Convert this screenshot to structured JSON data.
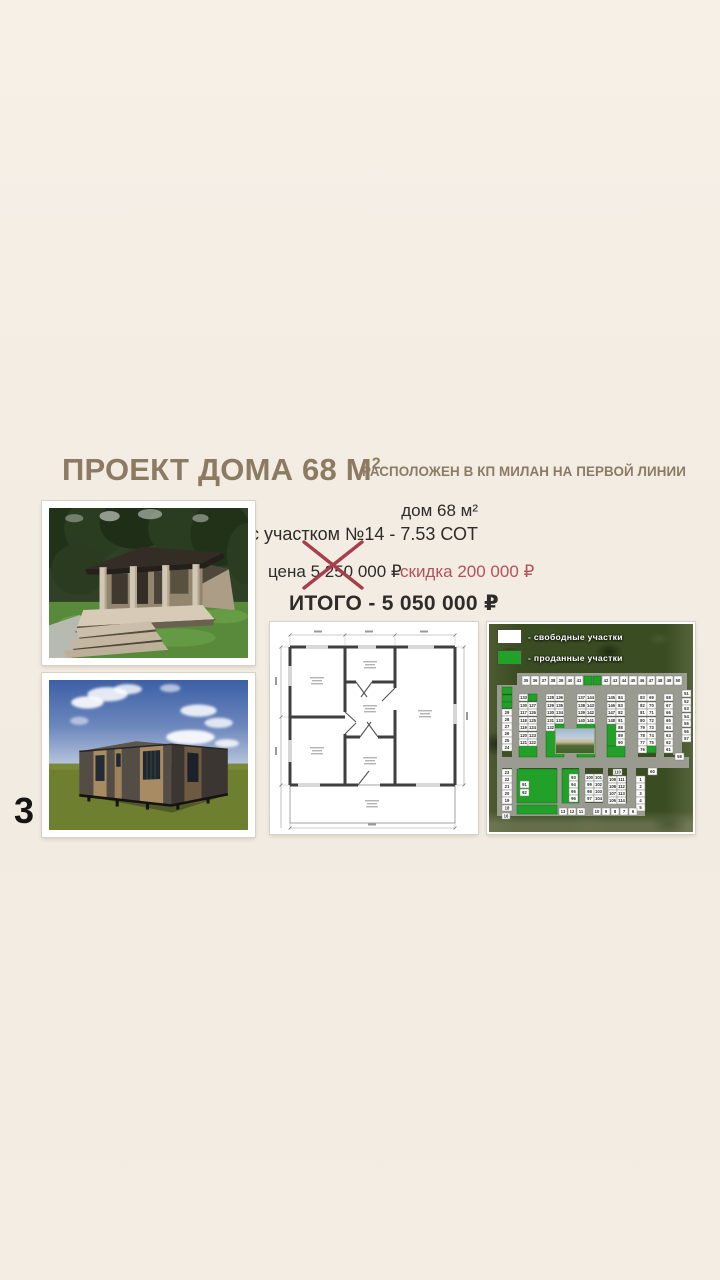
{
  "slide": {
    "number": "3"
  },
  "header": {
    "title_main": "ПРОЕКТ ДОМА 68 М",
    "title_sup": "2",
    "subtitle": "РАСПОЛОЖЕН В КП МИЛАН НА ПЕРВОЙ ЛИНИИ",
    "accent_color": "#8c7b63"
  },
  "offer": {
    "house_line": "дом 68 м²",
    "plot_line": "с участком №14 - 7.53 СОТ",
    "old_price": "цена 5 250 000 ₽",
    "discount": "скидка 200 000 ₽",
    "total": "ИТОГО - 5 050 000 ₽",
    "discount_color": "#b4515b"
  },
  "map": {
    "free_color": "#ffffff",
    "sold_color": "#21a127",
    "legend": [
      {
        "color": "#ffffff",
        "label": "- свободные участки"
      },
      {
        "color": "#21a127",
        "label": "- проданные участки"
      }
    ],
    "areas": [
      {
        "x": 30,
        "y": 122,
        "w": 18,
        "h": 11
      },
      {
        "x": 57,
        "y": 107,
        "w": 18,
        "h": 26
      },
      {
        "x": 88,
        "y": 100,
        "w": 18,
        "h": 33
      },
      {
        "x": 118,
        "y": 100,
        "w": 9,
        "h": 22
      },
      {
        "x": 118,
        "y": 122,
        "w": 18,
        "h": 11
      },
      {
        "x": 28,
        "y": 145,
        "w": 40,
        "h": 34
      },
      {
        "x": 73,
        "y": 145,
        "w": 17,
        "h": 34
      },
      {
        "x": 28,
        "y": 181,
        "w": 40,
        "h": 9
      }
    ],
    "cells": [
      {
        "x": 33,
        "y": 52,
        "w": 8,
        "h": 9,
        "n": "35"
      },
      {
        "x": 42,
        "y": 52,
        "w": 8,
        "h": 9,
        "n": "36"
      },
      {
        "x": 51,
        "y": 52,
        "w": 8,
        "h": 9,
        "n": "37"
      },
      {
        "x": 60,
        "y": 52,
        "w": 8,
        "h": 9,
        "n": "38"
      },
      {
        "x": 68,
        "y": 52,
        "w": 8,
        "h": 9,
        "n": "39"
      },
      {
        "x": 77,
        "y": 52,
        "w": 8,
        "h": 9,
        "n": "40"
      },
      {
        "x": 86,
        "y": 52,
        "w": 8,
        "h": 9,
        "n": "41"
      },
      {
        "x": 95,
        "y": 52,
        "w": 8,
        "h": 9,
        "s": 1
      },
      {
        "x": 104,
        "y": 52,
        "w": 8,
        "h": 9,
        "s": 1
      },
      {
        "x": 113,
        "y": 52,
        "w": 8,
        "h": 9,
        "n": "42"
      },
      {
        "x": 122,
        "y": 52,
        "w": 8,
        "h": 9,
        "n": "43"
      },
      {
        "x": 131,
        "y": 52,
        "w": 8,
        "h": 9,
        "n": "44"
      },
      {
        "x": 140,
        "y": 52,
        "w": 8,
        "h": 9,
        "n": "45"
      },
      {
        "x": 149,
        "y": 52,
        "w": 8,
        "h": 9,
        "n": "46"
      },
      {
        "x": 158,
        "y": 52,
        "w": 8,
        "h": 9,
        "n": "47"
      },
      {
        "x": 167,
        "y": 52,
        "w": 8,
        "h": 9,
        "n": "48"
      },
      {
        "x": 176,
        "y": 52,
        "w": 8,
        "h": 9,
        "n": "49"
      },
      {
        "x": 185,
        "y": 52,
        "w": 8,
        "h": 9,
        "n": "50"
      },
      {
        "x": 193,
        "y": 66,
        "w": 9,
        "h": 7,
        "n": "51"
      },
      {
        "x": 193,
        "y": 74,
        "w": 9,
        "h": 7,
        "n": "52"
      },
      {
        "x": 193,
        "y": 81,
        "w": 9,
        "h": 7,
        "n": "53"
      },
      {
        "x": 193,
        "y": 89,
        "w": 9,
        "h": 7,
        "n": "54"
      },
      {
        "x": 193,
        "y": 96,
        "w": 9,
        "h": 7,
        "n": "55"
      },
      {
        "x": 193,
        "y": 104,
        "w": 9,
        "h": 7,
        "n": "56"
      },
      {
        "x": 193,
        "y": 111,
        "w": 9,
        "h": 7,
        "n": "57"
      },
      {
        "x": 186,
        "y": 129,
        "w": 9,
        "h": 7,
        "n": "58"
      },
      {
        "x": 13,
        "y": 63,
        "w": 10,
        "h": 7,
        "s": 1
      },
      {
        "x": 13,
        "y": 71,
        "w": 10,
        "h": 7,
        "s": 1
      },
      {
        "x": 13,
        "y": 78,
        "w": 10,
        "h": 6,
        "s": 1
      },
      {
        "x": 13,
        "y": 85,
        "w": 10,
        "h": 7,
        "n": "29"
      },
      {
        "x": 13,
        "y": 92,
        "w": 10,
        "h": 7,
        "n": "28"
      },
      {
        "x": 13,
        "y": 99,
        "w": 10,
        "h": 7,
        "n": "27"
      },
      {
        "x": 13,
        "y": 106,
        "w": 10,
        "h": 7,
        "n": "26"
      },
      {
        "x": 13,
        "y": 113,
        "w": 10,
        "h": 7,
        "n": "25"
      },
      {
        "x": 13,
        "y": 120,
        "w": 10,
        "h": 7,
        "n": "24"
      },
      {
        "x": 30,
        "y": 70,
        "w": 9,
        "h": 7,
        "n": "133"
      },
      {
        "x": 39,
        "y": 70,
        "w": 9,
        "h": 7,
        "s": 1
      },
      {
        "x": 30,
        "y": 78,
        "w": 9,
        "h": 7,
        "n": "130"
      },
      {
        "x": 39,
        "y": 78,
        "w": 9,
        "h": 7,
        "n": "127"
      },
      {
        "x": 30,
        "y": 85,
        "w": 9,
        "h": 7,
        "n": "117"
      },
      {
        "x": 39,
        "y": 85,
        "w": 9,
        "h": 7,
        "n": "126"
      },
      {
        "x": 30,
        "y": 93,
        "w": 9,
        "h": 7,
        "n": "118"
      },
      {
        "x": 39,
        "y": 93,
        "w": 9,
        "h": 7,
        "n": "125"
      },
      {
        "x": 30,
        "y": 100,
        "w": 9,
        "h": 7,
        "n": "119"
      },
      {
        "x": 39,
        "y": 100,
        "w": 9,
        "h": 7,
        "n": "124"
      },
      {
        "x": 30,
        "y": 108,
        "w": 9,
        "h": 7,
        "n": "120"
      },
      {
        "x": 39,
        "y": 108,
        "w": 9,
        "h": 7,
        "n": "123"
      },
      {
        "x": 30,
        "y": 115,
        "w": 9,
        "h": 7,
        "n": "121"
      },
      {
        "x": 39,
        "y": 115,
        "w": 9,
        "h": 7,
        "n": "122"
      },
      {
        "x": 57,
        "y": 70,
        "w": 9,
        "h": 7,
        "n": "128"
      },
      {
        "x": 66,
        "y": 70,
        "w": 9,
        "h": 7,
        "n": "136"
      },
      {
        "x": 57,
        "y": 78,
        "w": 9,
        "h": 7,
        "n": "129"
      },
      {
        "x": 66,
        "y": 78,
        "w": 9,
        "h": 7,
        "n": "135"
      },
      {
        "x": 57,
        "y": 85,
        "w": 9,
        "h": 7,
        "n": "130"
      },
      {
        "x": 66,
        "y": 85,
        "w": 9,
        "h": 7,
        "n": "134"
      },
      {
        "x": 57,
        "y": 93,
        "w": 9,
        "h": 7,
        "n": "131"
      },
      {
        "x": 66,
        "y": 93,
        "w": 9,
        "h": 7,
        "n": "133"
      },
      {
        "x": 57,
        "y": 100,
        "w": 9,
        "h": 7,
        "n": "132"
      },
      {
        "x": 66,
        "y": 100,
        "w": 9,
        "h": 7,
        "s": 1
      },
      {
        "x": 88,
        "y": 70,
        "w": 9,
        "h": 7,
        "n": "137"
      },
      {
        "x": 97,
        "y": 70,
        "w": 9,
        "h": 7,
        "n": "144"
      },
      {
        "x": 88,
        "y": 78,
        "w": 9,
        "h": 7,
        "n": "138"
      },
      {
        "x": 97,
        "y": 78,
        "w": 9,
        "h": 7,
        "n": "143"
      },
      {
        "x": 88,
        "y": 85,
        "w": 9,
        "h": 7,
        "n": "139"
      },
      {
        "x": 97,
        "y": 85,
        "w": 9,
        "h": 7,
        "n": "142"
      },
      {
        "x": 88,
        "y": 93,
        "w": 9,
        "h": 7,
        "n": "140"
      },
      {
        "x": 97,
        "y": 93,
        "w": 9,
        "h": 7,
        "n": "141"
      },
      {
        "x": 118,
        "y": 70,
        "w": 9,
        "h": 7,
        "n": "145"
      },
      {
        "x": 127,
        "y": 70,
        "w": 9,
        "h": 7,
        "n": "84"
      },
      {
        "x": 118,
        "y": 78,
        "w": 9,
        "h": 7,
        "n": "146"
      },
      {
        "x": 127,
        "y": 78,
        "w": 9,
        "h": 7,
        "n": "83"
      },
      {
        "x": 118,
        "y": 85,
        "w": 9,
        "h": 7,
        "n": "147"
      },
      {
        "x": 127,
        "y": 85,
        "w": 9,
        "h": 7,
        "n": "82"
      },
      {
        "x": 118,
        "y": 93,
        "w": 9,
        "h": 7,
        "n": "148"
      },
      {
        "x": 127,
        "y": 93,
        "w": 9,
        "h": 7,
        "n": "81"
      },
      {
        "x": 127,
        "y": 100,
        "w": 9,
        "h": 7,
        "n": "88"
      },
      {
        "x": 127,
        "y": 108,
        "w": 9,
        "h": 7,
        "n": "89"
      },
      {
        "x": 127,
        "y": 115,
        "w": 9,
        "h": 7,
        "n": "90"
      },
      {
        "x": 149,
        "y": 70,
        "w": 9,
        "h": 7,
        "n": "83"
      },
      {
        "x": 158,
        "y": 70,
        "w": 9,
        "h": 7,
        "n": "69"
      },
      {
        "x": 149,
        "y": 78,
        "w": 9,
        "h": 7,
        "n": "82"
      },
      {
        "x": 158,
        "y": 78,
        "w": 9,
        "h": 7,
        "n": "70"
      },
      {
        "x": 149,
        "y": 85,
        "w": 9,
        "h": 7,
        "n": "81"
      },
      {
        "x": 158,
        "y": 85,
        "w": 9,
        "h": 7,
        "n": "71"
      },
      {
        "x": 149,
        "y": 93,
        "w": 9,
        "h": 7,
        "n": "80"
      },
      {
        "x": 158,
        "y": 93,
        "w": 9,
        "h": 7,
        "n": "72"
      },
      {
        "x": 149,
        "y": 100,
        "w": 9,
        "h": 7,
        "n": "79"
      },
      {
        "x": 158,
        "y": 100,
        "w": 9,
        "h": 7,
        "n": "73"
      },
      {
        "x": 149,
        "y": 108,
        "w": 9,
        "h": 7,
        "n": "78"
      },
      {
        "x": 158,
        "y": 108,
        "w": 9,
        "h": 7,
        "n": "74"
      },
      {
        "x": 149,
        "y": 115,
        "w": 9,
        "h": 7,
        "n": "77"
      },
      {
        "x": 158,
        "y": 115,
        "w": 9,
        "h": 7,
        "n": "75"
      },
      {
        "x": 149,
        "y": 122,
        "w": 9,
        "h": 7,
        "n": "76"
      },
      {
        "x": 158,
        "y": 122,
        "w": 9,
        "h": 7,
        "s": 1
      },
      {
        "x": 175,
        "y": 70,
        "w": 9,
        "h": 7,
        "n": "68"
      },
      {
        "x": 175,
        "y": 78,
        "w": 9,
        "h": 7,
        "n": "67"
      },
      {
        "x": 175,
        "y": 85,
        "w": 9,
        "h": 7,
        "n": "66"
      },
      {
        "x": 175,
        "y": 93,
        "w": 9,
        "h": 7,
        "n": "65"
      },
      {
        "x": 175,
        "y": 100,
        "w": 9,
        "h": 7,
        "n": "64"
      },
      {
        "x": 175,
        "y": 108,
        "w": 9,
        "h": 7,
        "n": "63"
      },
      {
        "x": 175,
        "y": 115,
        "w": 9,
        "h": 7,
        "n": "62"
      },
      {
        "x": 175,
        "y": 122,
        "w": 9,
        "h": 7,
        "n": "61"
      },
      {
        "x": 13,
        "y": 145,
        "w": 10,
        "h": 7,
        "n": "23"
      },
      {
        "x": 13,
        "y": 152,
        "w": 10,
        "h": 7,
        "n": "22"
      },
      {
        "x": 13,
        "y": 159,
        "w": 10,
        "h": 7,
        "n": "21"
      },
      {
        "x": 13,
        "y": 166,
        "w": 10,
        "h": 7,
        "n": "20"
      },
      {
        "x": 13,
        "y": 173,
        "w": 10,
        "h": 7,
        "n": "19"
      },
      {
        "x": 13,
        "y": 181,
        "w": 10,
        "h": 6,
        "n": "18"
      },
      {
        "x": 13,
        "y": 189,
        "w": 8,
        "h": 6,
        "n": "16"
      },
      {
        "x": 31,
        "y": 157,
        "w": 9,
        "h": 7,
        "n": "91"
      },
      {
        "x": 31,
        "y": 165,
        "w": 9,
        "h": 7,
        "n": "92"
      },
      {
        "x": 80,
        "y": 150,
        "w": 9,
        "h": 7,
        "n": "93"
      },
      {
        "x": 80,
        "y": 157,
        "w": 9,
        "h": 7,
        "n": "94"
      },
      {
        "x": 80,
        "y": 164,
        "w": 9,
        "h": 7,
        "n": "95"
      },
      {
        "x": 80,
        "y": 171,
        "w": 9,
        "h": 7,
        "n": "96"
      },
      {
        "x": 96,
        "y": 150,
        "w": 9,
        "h": 7,
        "n": "100"
      },
      {
        "x": 105,
        "y": 150,
        "w": 9,
        "h": 7,
        "n": "101"
      },
      {
        "x": 96,
        "y": 157,
        "w": 9,
        "h": 7,
        "n": "99"
      },
      {
        "x": 105,
        "y": 157,
        "w": 9,
        "h": 7,
        "n": "102"
      },
      {
        "x": 96,
        "y": 164,
        "w": 9,
        "h": 7,
        "n": "98"
      },
      {
        "x": 105,
        "y": 164,
        "w": 9,
        "h": 7,
        "n": "103"
      },
      {
        "x": 96,
        "y": 171,
        "w": 9,
        "h": 7,
        "n": "97"
      },
      {
        "x": 105,
        "y": 171,
        "w": 9,
        "h": 7,
        "n": "104"
      },
      {
        "x": 124,
        "y": 145,
        "w": 9,
        "h": 6,
        "n": "110"
      },
      {
        "x": 119,
        "y": 152,
        "w": 9,
        "h": 7,
        "n": "109"
      },
      {
        "x": 128,
        "y": 152,
        "w": 9,
        "h": 7,
        "n": "111"
      },
      {
        "x": 119,
        "y": 159,
        "w": 9,
        "h": 7,
        "n": "108"
      },
      {
        "x": 128,
        "y": 159,
        "w": 9,
        "h": 7,
        "n": "112"
      },
      {
        "x": 119,
        "y": 166,
        "w": 9,
        "h": 7,
        "n": "107"
      },
      {
        "x": 128,
        "y": 166,
        "w": 9,
        "h": 7,
        "n": "113"
      },
      {
        "x": 119,
        "y": 173,
        "w": 9,
        "h": 7,
        "n": "106"
      },
      {
        "x": 128,
        "y": 173,
        "w": 9,
        "h": 7,
        "n": "114"
      },
      {
        "x": 147,
        "y": 152,
        "w": 9,
        "h": 7,
        "n": "1"
      },
      {
        "x": 147,
        "y": 159,
        "w": 9,
        "h": 7,
        "n": "2"
      },
      {
        "x": 147,
        "y": 166,
        "w": 9,
        "h": 7,
        "n": "3"
      },
      {
        "x": 147,
        "y": 173,
        "w": 9,
        "h": 7,
        "n": "4"
      },
      {
        "x": 147,
        "y": 180,
        "w": 9,
        "h": 7,
        "n": "5"
      },
      {
        "x": 159,
        "y": 144,
        "w": 9,
        "h": 7,
        "n": "60"
      },
      {
        "x": 70,
        "y": 184,
        "w": 8,
        "h": 7,
        "n": "13"
      },
      {
        "x": 79,
        "y": 184,
        "w": 8,
        "h": 7,
        "n": "12"
      },
      {
        "x": 88,
        "y": 184,
        "w": 8,
        "h": 7,
        "n": "11"
      },
      {
        "x": 104,
        "y": 184,
        "w": 8,
        "h": 7,
        "n": "10"
      },
      {
        "x": 113,
        "y": 184,
        "w": 8,
        "h": 7,
        "n": "9"
      },
      {
        "x": 122,
        "y": 184,
        "w": 8,
        "h": 7,
        "n": "8"
      },
      {
        "x": 131,
        "y": 184,
        "w": 8,
        "h": 7,
        "n": "7"
      },
      {
        "x": 140,
        "y": 184,
        "w": 8,
        "h": 7,
        "n": "6"
      }
    ]
  }
}
